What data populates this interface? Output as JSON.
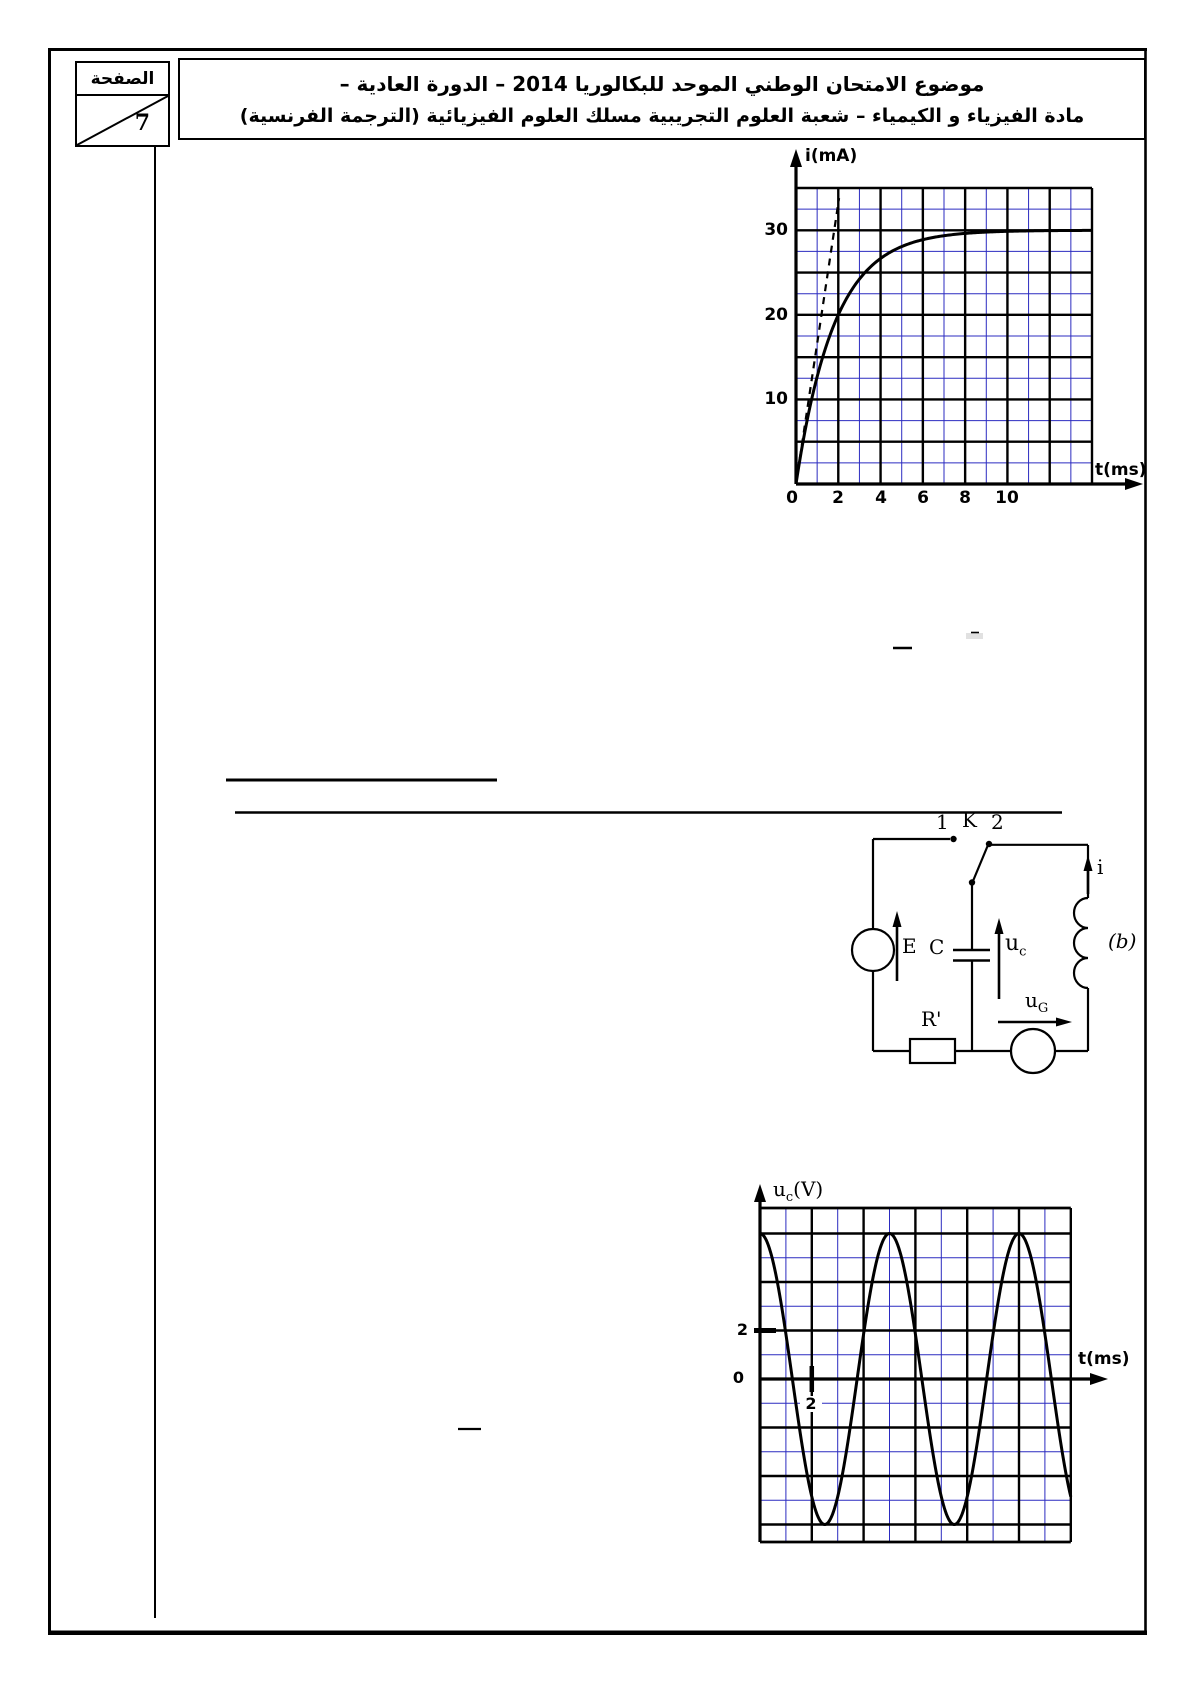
{
  "page_box": {
    "label": "الصفحة",
    "number": "7"
  },
  "header": {
    "line1": "موضوع الامتحان الوطني الموحد للبكالوريا 2014  –  الدورة العادية  –",
    "line2": "مادة الفيزياء و الكيمياء – شعبة العلوم التجريبية مسلك العلوم الفيزيائية (الترجمة الفرنسية)"
  },
  "chart_data": [
    {
      "type": "line",
      "name": "coil-current-step-response",
      "title": "",
      "ylabel": "i(mA)",
      "xlabel": "t(ms)",
      "x_range_ms": [
        0,
        14
      ],
      "y_range_mA": [
        0,
        35
      ],
      "x_major_ms": 2,
      "x_minor_ms": 1,
      "y_major_mA": 5,
      "y_minor_mA": 2.5,
      "x_tick_labels": [
        "0",
        "2",
        "4",
        "6",
        "8",
        "10"
      ],
      "y_tick_labels": [
        "10",
        "20",
        "30"
      ],
      "grid_major_color": "#000000",
      "grid_minor_color": "#2b2bc0",
      "asymptote_mA": 30,
      "time_constant_ms": 1.82,
      "tangent": {
        "style": "dashed",
        "from_t_ms": 0,
        "slope_mA_per_ms": 16.6,
        "end_mA": 33.8
      },
      "series": [
        {
          "name": "i(t)",
          "x_ms": [
            0,
            1,
            2,
            3,
            4,
            5,
            6,
            8,
            10,
            12,
            14
          ],
          "y_mA": [
            0,
            12.7,
            20.0,
            24.2,
            26.7,
            28.1,
            28.9,
            29.6,
            29.9,
            30.0,
            30.0
          ]
        }
      ]
    },
    {
      "type": "line",
      "name": "capacitor-voltage-oscillations",
      "title": "",
      "ylabel_base": "u",
      "ylabel_sub": "c",
      "ylabel_unit": "(V)",
      "xlabel": "t(ms)",
      "x_range_ms": [
        0,
        12
      ],
      "y_range_V": [
        -6.7,
        7.1
      ],
      "x_major_ms": 2,
      "x_minor_ms": 1,
      "y_major_V": 2,
      "y_minor_V": 1,
      "x_tick_labels": [
        "2"
      ],
      "y_tick_labels": [
        "2",
        "0"
      ],
      "grid_major_color": "#000000",
      "grid_minor_color": "#2b2bc0",
      "amplitude_V": 6,
      "period_ms": 5,
      "series": [
        {
          "name": "uc(t)",
          "x_ms": [
            0,
            1.25,
            2.5,
            3.75,
            5,
            6.25,
            7.5,
            8.75,
            10,
            11.25,
            12
          ],
          "y_V": [
            6,
            0,
            -6,
            0,
            6,
            0,
            -6,
            0,
            6,
            0,
            -4.9
          ]
        }
      ]
    }
  ],
  "circuit": {
    "switch_pos1": "1",
    "switch_label": "K",
    "switch_pos2": "2",
    "source_label": "E",
    "capacitor_label": "C",
    "uc_base": "u",
    "uc_sub": "c",
    "current_label": "i",
    "coil_label": "(b)",
    "resistor_label": "R'",
    "ug_base": "u",
    "ug_sub": "G"
  }
}
